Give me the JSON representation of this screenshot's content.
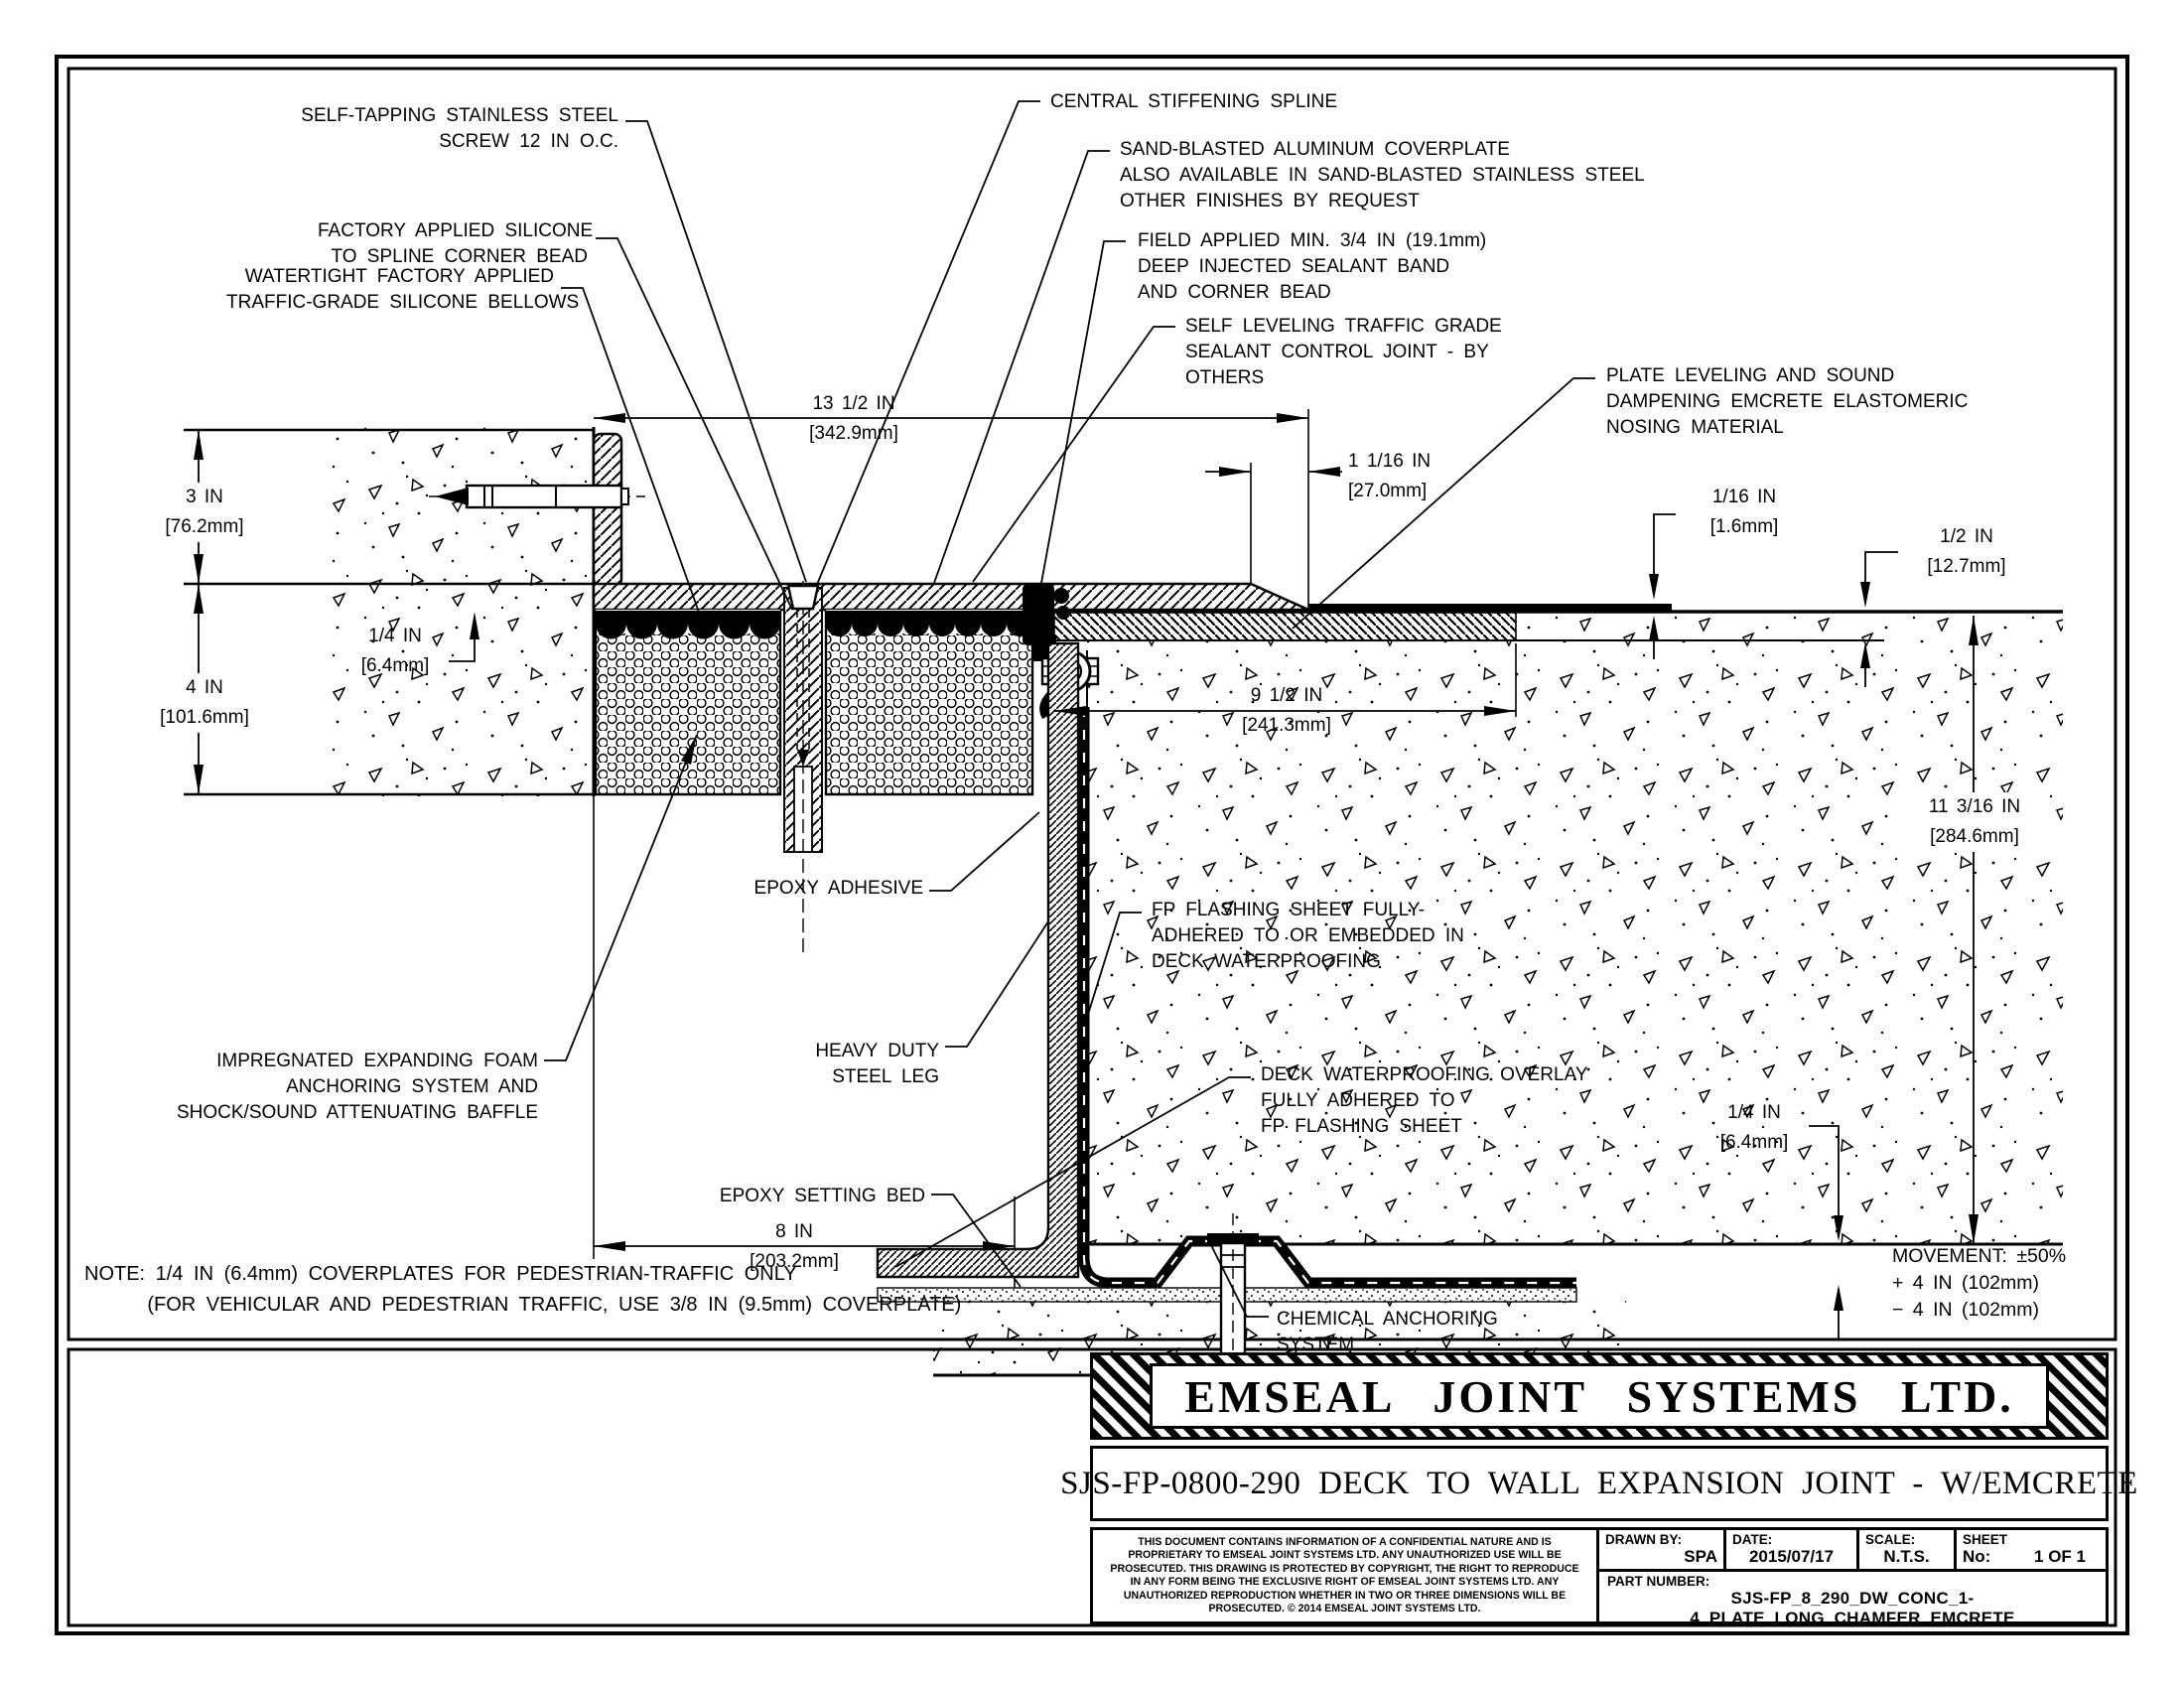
{
  "callouts": {
    "screw": "SELF-TAPPING STAINLESS STEEL\nSCREW 12 IN O.C.",
    "silicone_bead": "FACTORY APPLIED SILICONE\nTO SPLINE CORNER BEAD",
    "bellows": "WATERTIGHT FACTORY APPLIED\nTRAFFIC-GRADE SILICONE BELLOWS",
    "spline": "CENTRAL STIFFENING SPLINE",
    "coverplate": "SAND-BLASTED ALUMINUM COVERPLATE\nALSO AVAILABLE IN SAND-BLASTED STAINLESS STEEL\nOTHER FINISHES BY REQUEST",
    "sealant_band": "FIELD APPLIED MIN. 3/4 IN (19.1mm)\nDEEP INJECTED SEALANT BAND\nAND CORNER BEAD",
    "control_joint": "SELF LEVELING TRAFFIC GRADE\nSEALANT CONTROL JOINT - BY\nOTHERS",
    "nosing": "PLATE LEVELING AND SOUND\nDAMPENING EMCRETE ELASTOMERIC\nNOSING MATERIAL",
    "epoxy_adhesive": "EPOXY ADHESIVE",
    "foam": "IMPREGNATED EXPANDING FOAM\nANCHORING SYSTEM AND\nSHOCK/SOUND ATTENUATING BAFFLE",
    "steel_leg": "HEAVY DUTY\nSTEEL LEG",
    "epoxy_bed": "EPOXY SETTING BED",
    "flashing": "FP FLASHING SHEET FULLY-\nADHERED TO OR EMBEDDED IN\nDECK WATERPROOFING",
    "overlay": "DECK WATERPROOFING OVERLAY\nFULLY ADHERED TO\nFP FLASHING SHEET",
    "anchor": "CHEMICAL ANCHORING\nSYSTEM"
  },
  "dims": {
    "plate_width": "13 1/2 IN\n[342.9mm]",
    "chamfer": "1 1/16 IN\n[27.0mm]",
    "upstand": "3 IN\n[76.2mm]",
    "foam_depth": "4 IN\n[101.6mm]",
    "plate_thickness": "1/4 IN\n[6.4mm]",
    "nosing_width": "9 1/2 IN\n[241.3mm]",
    "overlay_thickness": "1/16 IN\n[1.6mm]",
    "recess_depth": "1/2 IN\n[12.7mm]",
    "blockout_depth": "11 3/16 IN\n[284.6mm]",
    "blockout_width": "8 IN\n[203.2mm]",
    "flashing_gap": "1/4 IN\n[6.4mm]"
  },
  "note": "NOTE: 1/4 IN (6.4mm) COVERPLATES FOR PEDESTRIAN-TRAFFIC ONLY\n      (FOR VEHICULAR AND PEDESTRIAN TRAFFIC, USE 3/8 IN (9.5mm) COVERPLATE)",
  "movement": "MOVEMENT: ±50%\n+ 4 IN (102mm)\n− 4 IN (102mm)",
  "title_block": {
    "company": "EMSEAL JOINT SYSTEMS LTD.",
    "drawing_title": "SJS-FP-0800-290 DECK TO WALL EXPANSION JOINT - W/EMCRETE",
    "disclaimer": "THIS DOCUMENT CONTAINS INFORMATION OF A CONFIDENTIAL NATURE AND IS PROPRIETARY TO EMSEAL JOINT SYSTEMS LTD. ANY UNAUTHORIZED USE WILL BE PROSECUTED. THIS DRAWING IS PROTECTED BY COPYRIGHT, THE RIGHT TO REPRODUCE IN ANY FORM BEING THE EXCLUSIVE RIGHT OF EMSEAL JOINT SYSTEMS LTD. ANY UNAUTHORIZED REPRODUCTION WHETHER IN TWO OR THREE DIMENSIONS WILL BE PROSECUTED. © 2014 EMSEAL JOINT SYSTEMS LTD.",
    "drawn_by_label": "DRAWN BY:",
    "drawn_by": "SPA",
    "date_label": "DATE:",
    "date": "2015/07/17",
    "scale_label": "SCALE:",
    "scale": "N.T.S.",
    "sheet_label": "SHEET",
    "sheet_no_label": "No:",
    "sheet_no": "1 OF 1",
    "part_number_label": "PART NUMBER:",
    "part_number": "SJS-FP_8_290_DW_CONC_1-4_PLATE_LONG_CHAMFER_EMCRETE"
  }
}
